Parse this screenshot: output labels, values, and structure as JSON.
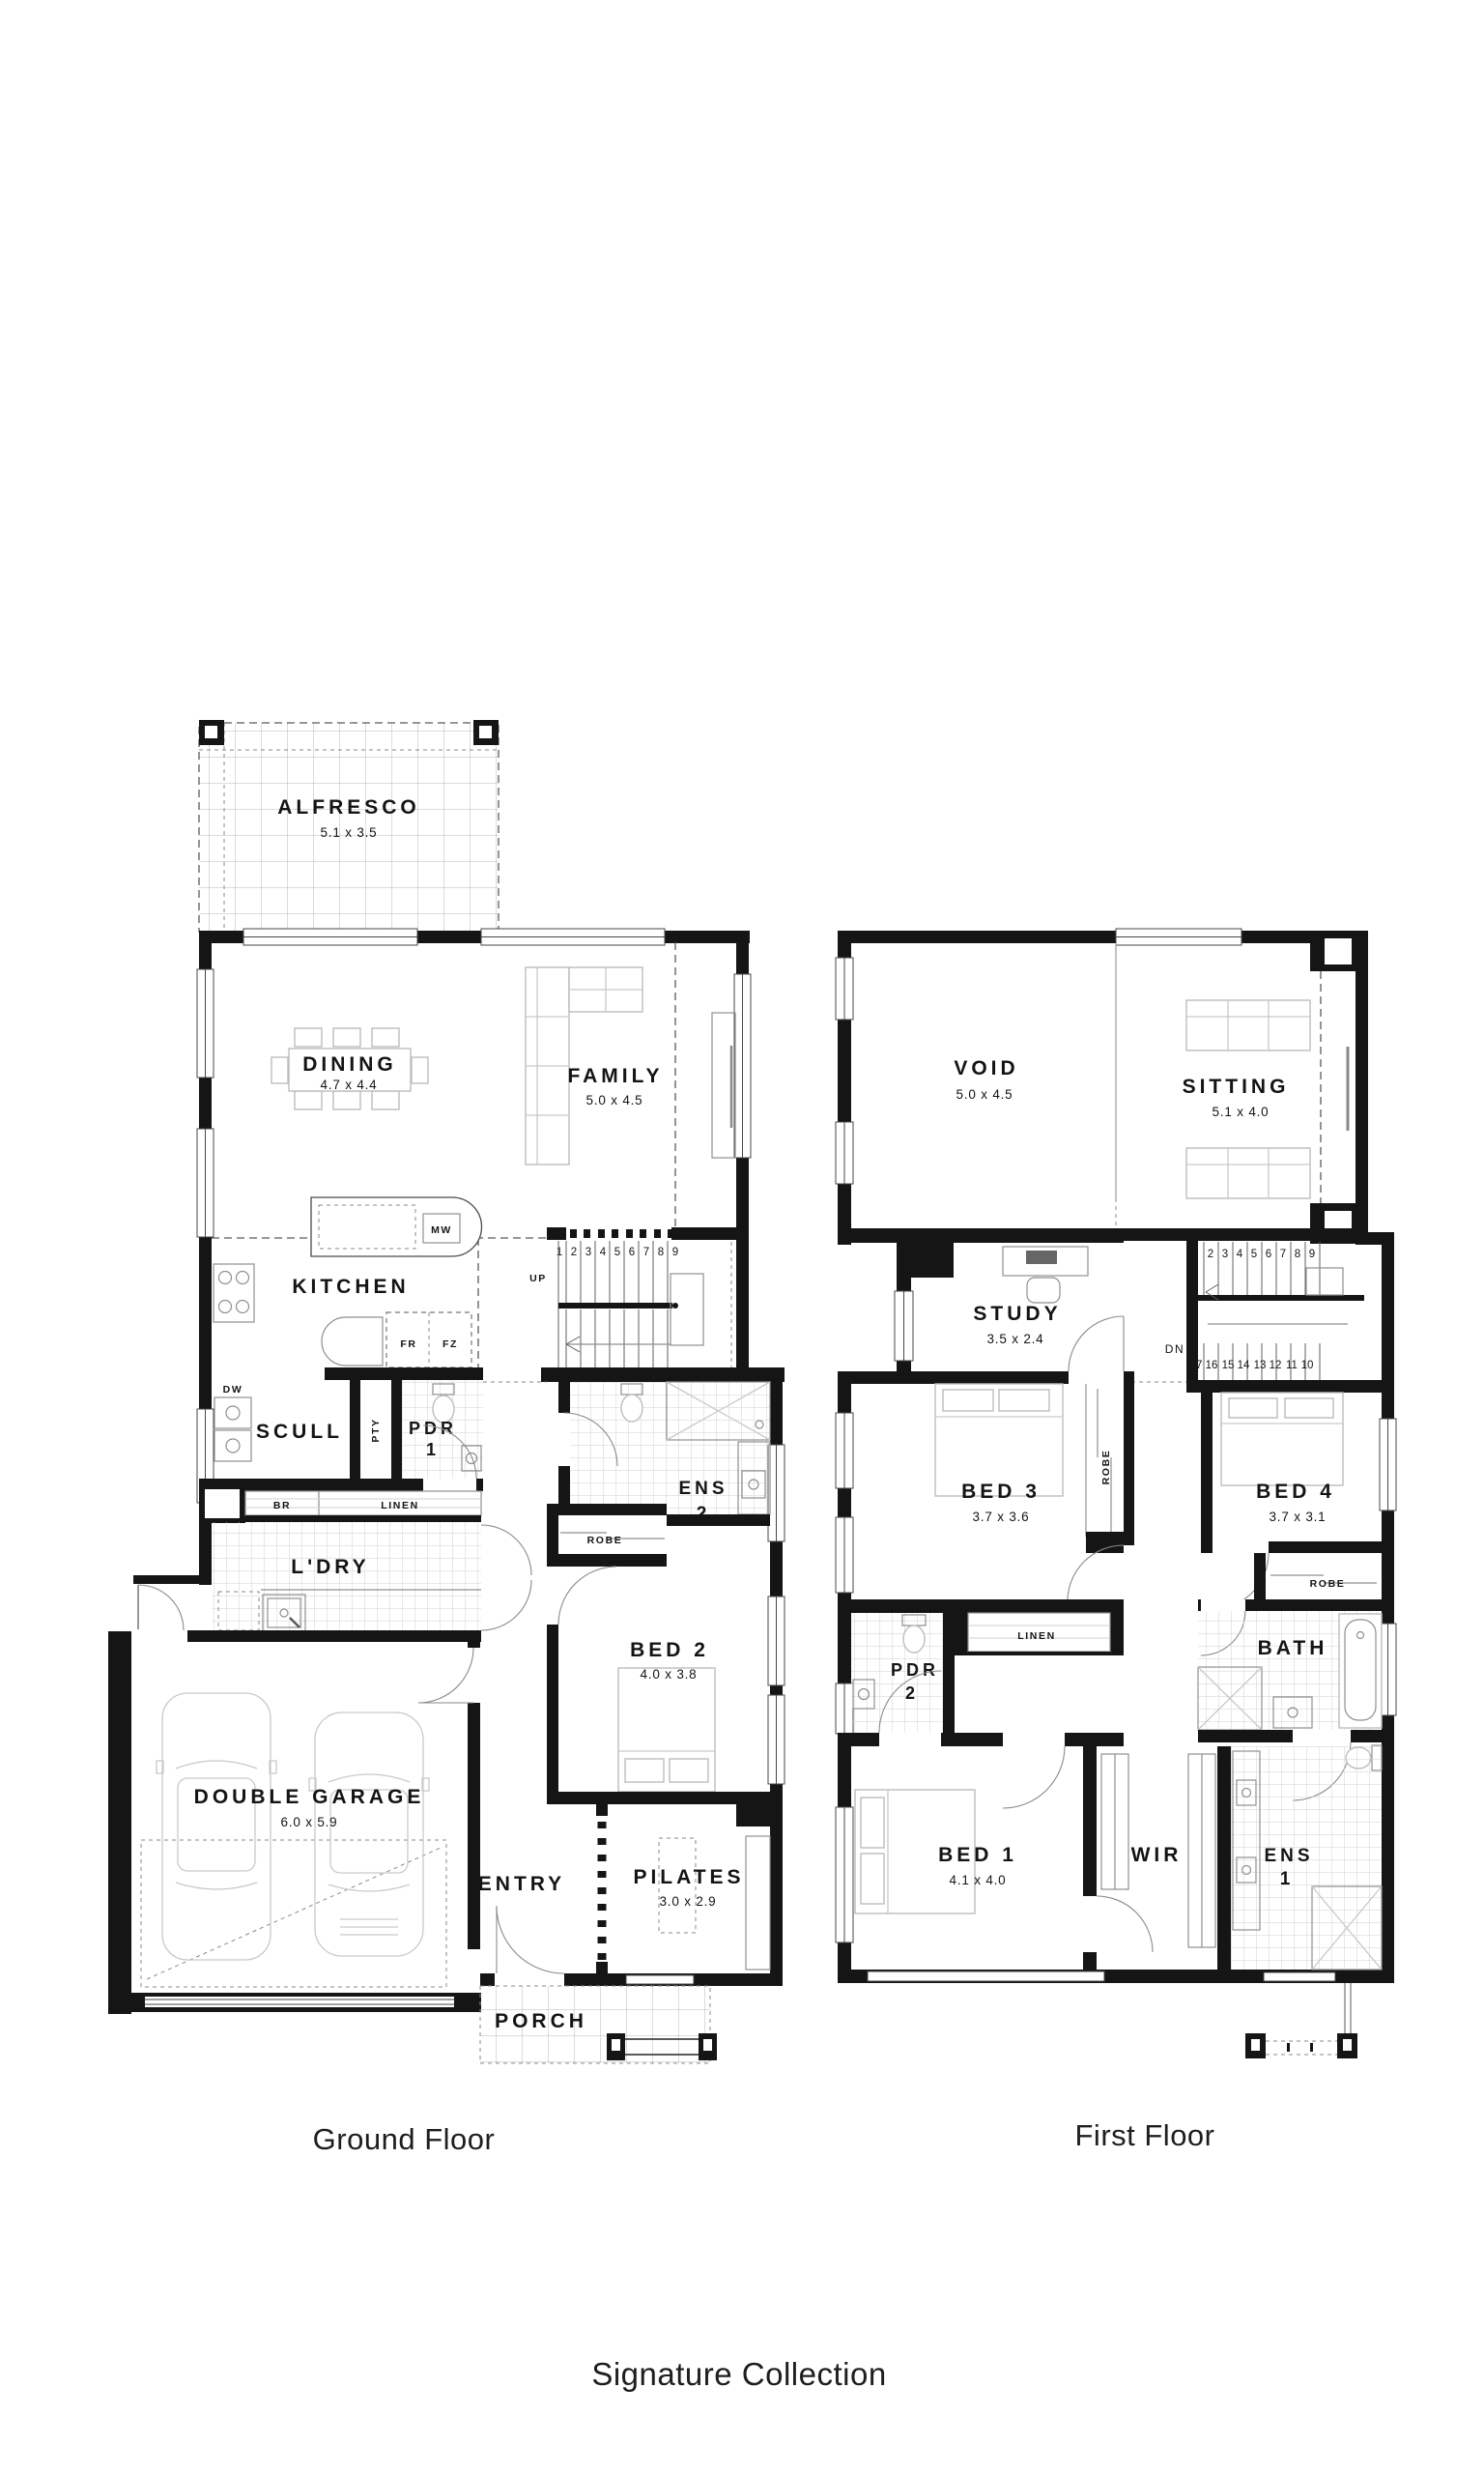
{
  "footer": {
    "ground_label": "Ground Floor",
    "first_label": "First Floor",
    "collection_label": "Signature Collection"
  },
  "ground": {
    "alfresco_name": "ALFRESCO",
    "alfresco_dim": "5.1 x 3.5",
    "dining_name": "DINING",
    "dining_dim": "4.7 x 4.4",
    "family_name": "FAMILY",
    "family_dim": "5.0 x 4.5",
    "kitchen_name": "KITCHEN",
    "scull_name": "SCULL",
    "pdr_name": "PDR",
    "pdr_num": "1",
    "pty": "PTY",
    "br": "BR",
    "linen": "LINEN",
    "ldry_name": "L'DRY",
    "dw": "DW",
    "mw": "MW",
    "fr": "FR",
    "fz": "FZ",
    "ens_name": "ENS",
    "ens_num": "2",
    "robe": "ROBE",
    "bed2_name": "BED 2",
    "bed2_dim": "4.0 x 3.8",
    "garage_name": "DOUBLE GARAGE",
    "garage_dim": "6.0 x 5.9",
    "entry_name": "ENTRY",
    "pilates_name": "PILATES",
    "pilates_dim": "3.0 x 2.9",
    "porch_name": "PORCH",
    "up": "UP",
    "stairs": [
      "1",
      "2",
      "3",
      "4",
      "5",
      "6",
      "7",
      "8",
      "9"
    ]
  },
  "first": {
    "void_name": "VOID",
    "void_dim": "5.0 x 4.5",
    "sitting_name": "SITTING",
    "sitting_dim": "5.1 x 4.0",
    "study_name": "STUDY",
    "study_dim": "3.5 x 2.4",
    "bed3_name": "BED 3",
    "bed3_dim": "3.7 x 3.6",
    "bed4_name": "BED 4",
    "bed4_dim": "3.7 x 3.1",
    "robe3": "ROBE",
    "robe4": "ROBE",
    "linen": "LINEN",
    "pdr_name": "PDR",
    "pdr_num": "2",
    "bath_name": "BATH",
    "bed1_name": "BED 1",
    "bed1_dim": "4.1 x 4.0",
    "wir_name": "WIR",
    "ens_name": "ENS",
    "ens_num": "1",
    "dn": "DN",
    "stairs_upper": [
      "2",
      "3",
      "4",
      "5",
      "6",
      "7",
      "8",
      "9"
    ],
    "stairs_lower": [
      "17",
      "16",
      "15",
      "14",
      "13",
      "12",
      "11",
      "10"
    ]
  }
}
